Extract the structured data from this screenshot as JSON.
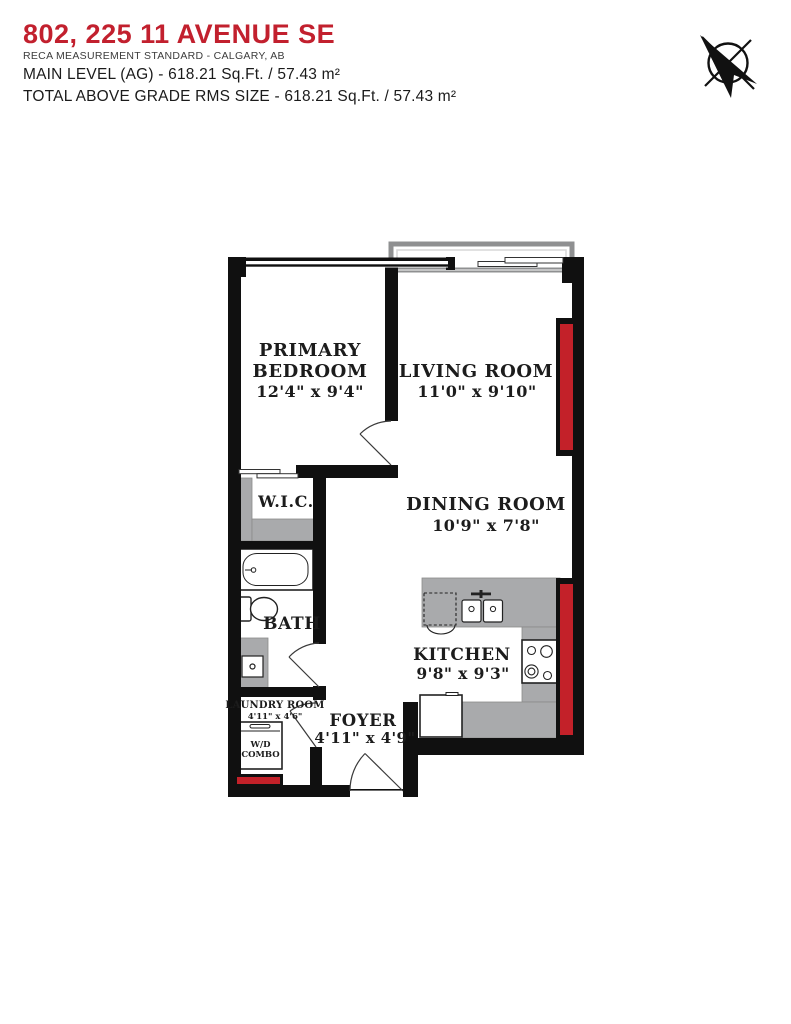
{
  "header": {
    "title": "802, 225 11 AVENUE SE",
    "subtitle": "RECA MEASUREMENT STANDARD - CALGARY, AB",
    "main_level": "MAIN LEVEL (AG) - 618.21 Sq.Ft. / 57.43 m²",
    "total": "TOTAL ABOVE GRADE RMS SIZE - 618.21 Sq.Ft. / 57.43 m²"
  },
  "colors": {
    "title_red": "#c2202e",
    "window_red": "#c32129",
    "wall_black": "#101010",
    "fixture_gray": "#a9aaac",
    "balcony_gray": "#8f9091"
  },
  "compass": {
    "icon": "north-arrow"
  },
  "rooms": {
    "primary_bedroom": {
      "line1": "PRIMARY",
      "line2": "BEDROOM",
      "dims": "12'4\" x 9'4\""
    },
    "living_room": {
      "line1": "LIVING ROOM",
      "dims": "11'0\" x 9'10\""
    },
    "dining_room": {
      "line1": "DINING ROOM",
      "dims": "10'9\" x 7'8\""
    },
    "wic": {
      "line1": "W.I.C."
    },
    "bath": {
      "line1": "BATH"
    },
    "kitchen": {
      "line1": "KITCHEN",
      "dims": "9'8\" x 9'3\""
    },
    "laundry": {
      "line1": "LAUNDRY ROOM",
      "dims": "4'11\" x 4'6\""
    },
    "foyer": {
      "line1": "FOYER",
      "dims": "4'11\" x 4'9\""
    },
    "wd_combo": {
      "line1": "W/D",
      "line2": "COMBO"
    }
  }
}
